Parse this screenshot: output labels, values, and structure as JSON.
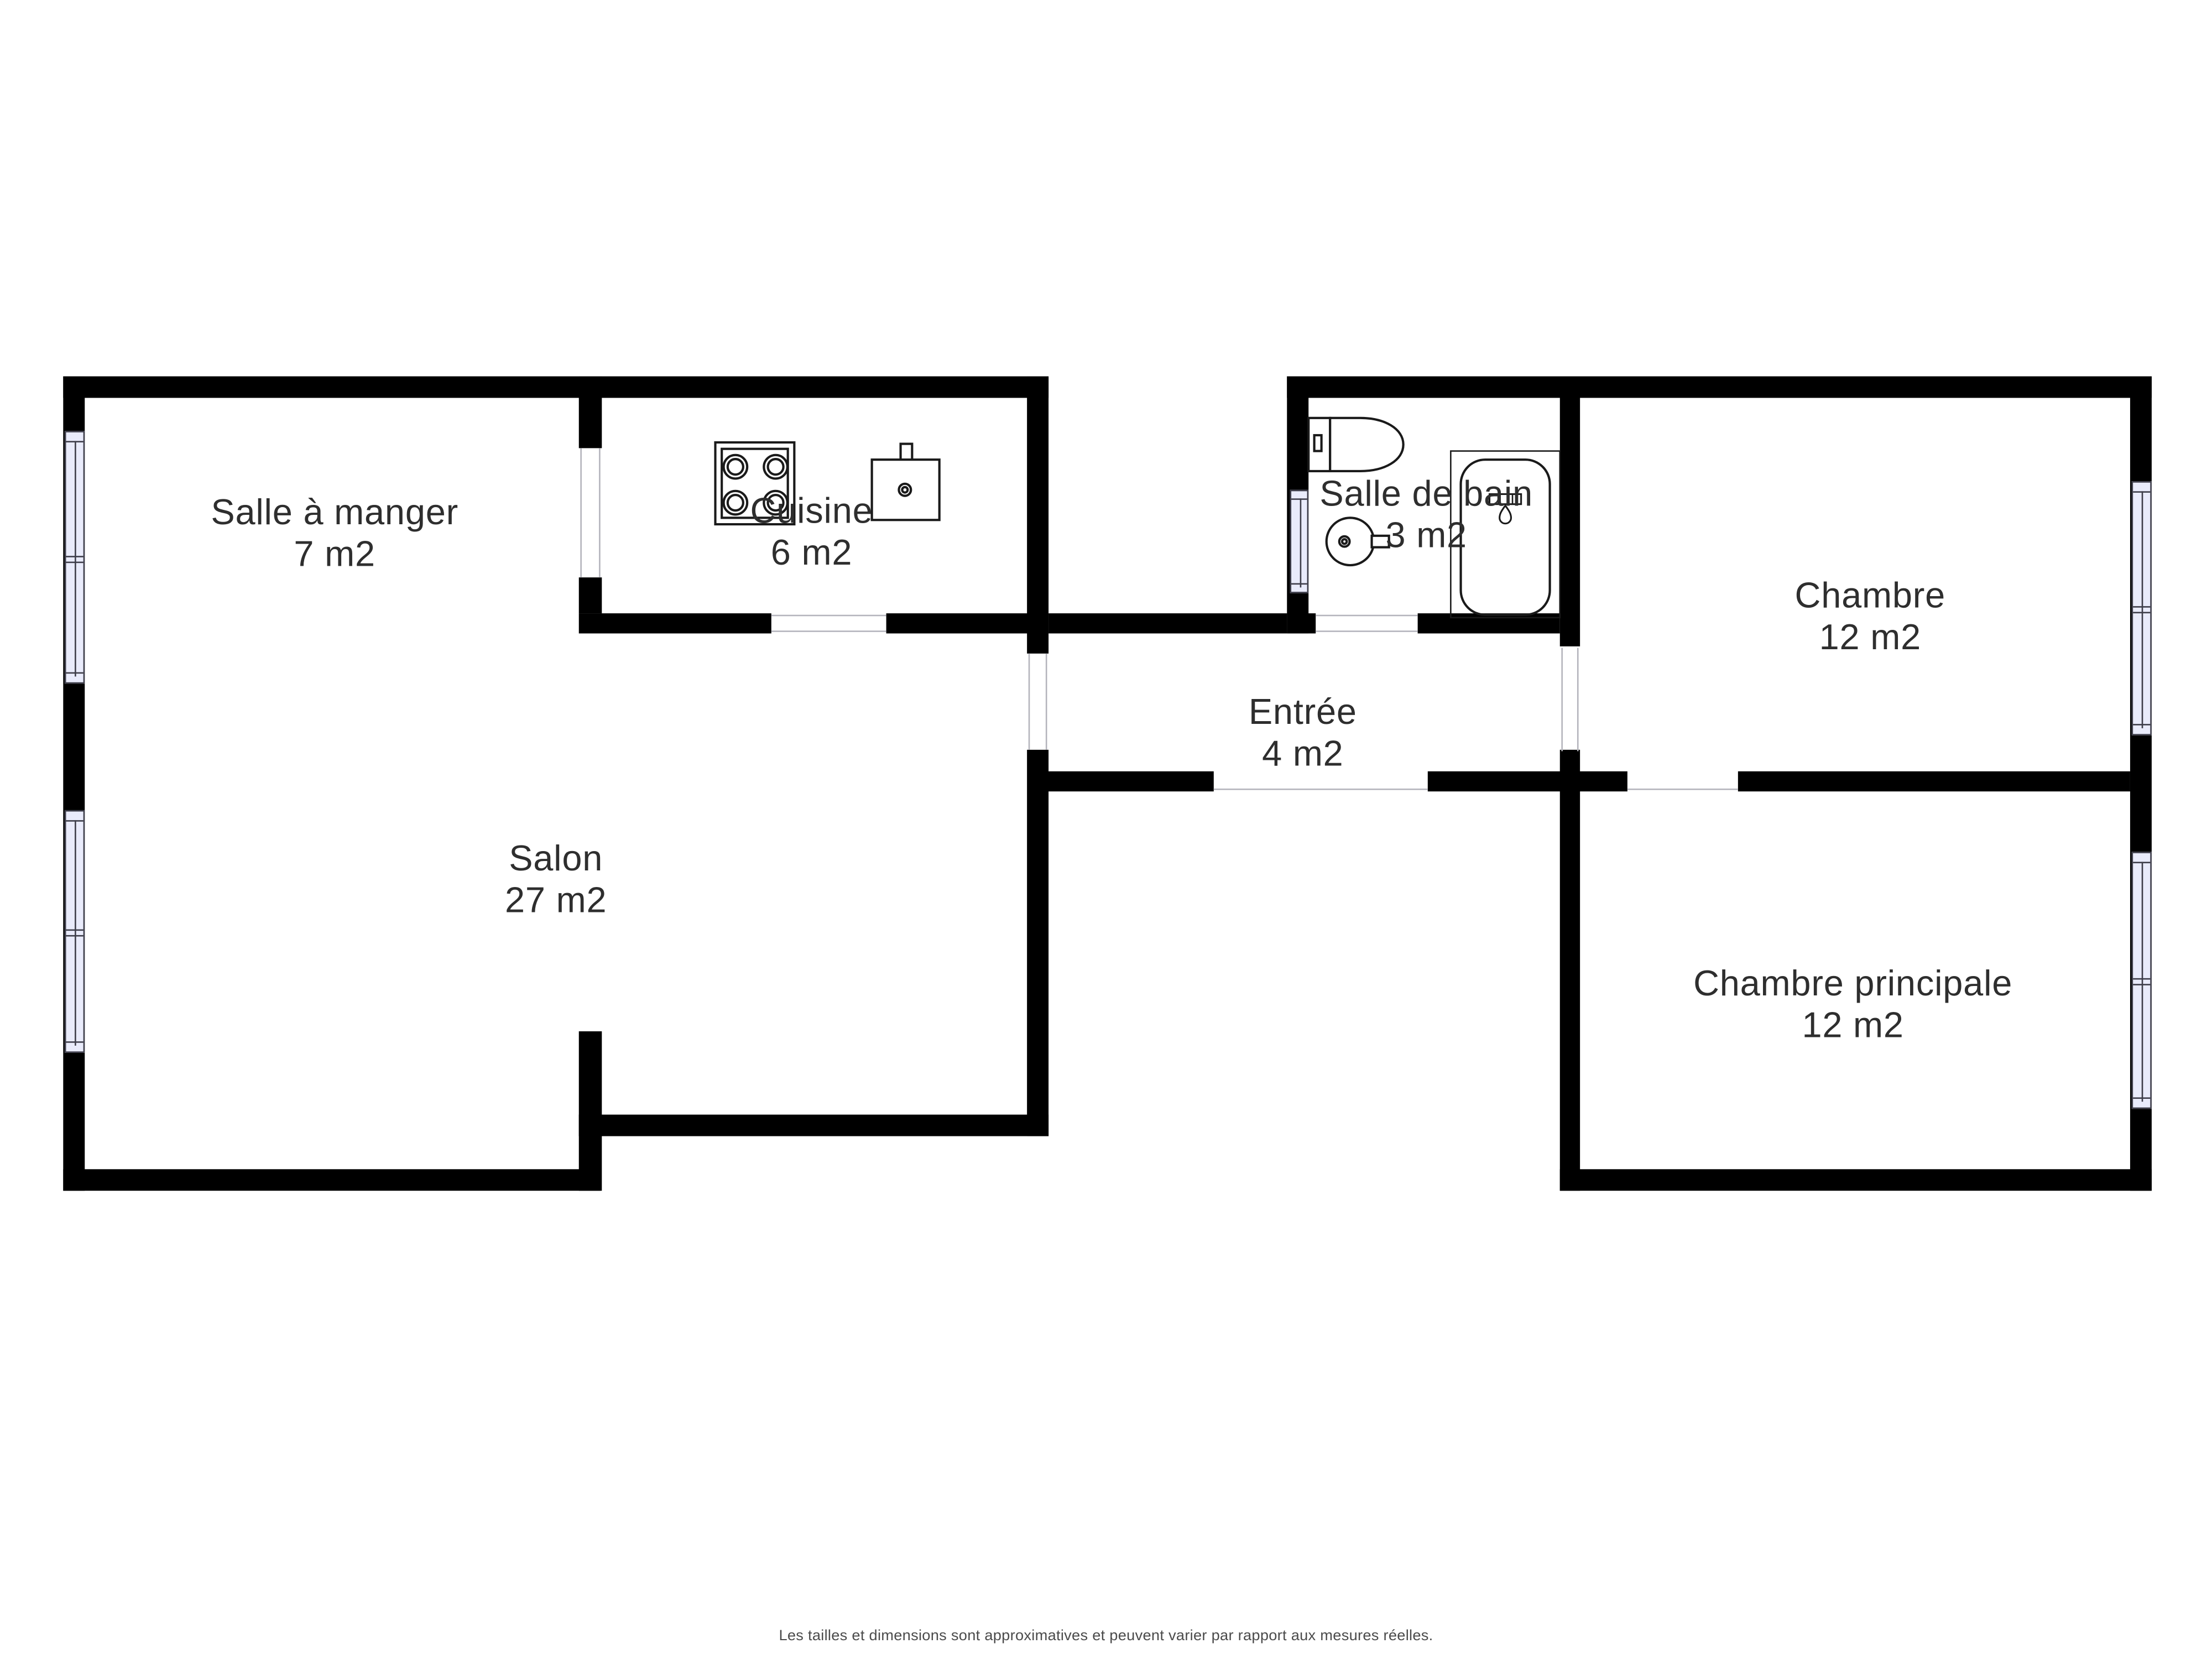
{
  "page": {
    "background": "#ffffff",
    "type": "apartment-floor-plan"
  },
  "rooms": [
    {
      "id": "salle-a-manger",
      "name": "Salle à manger",
      "area": "7 m2"
    },
    {
      "id": "cuisine",
      "name": "Cuisine",
      "area": "6 m2"
    },
    {
      "id": "salle-de-bain",
      "name": "Salle de bain",
      "area": "3 m2"
    },
    {
      "id": "chambre",
      "name": "Chambre",
      "area": "12 m2"
    },
    {
      "id": "entree",
      "name": "Entrée",
      "area": "4 m2"
    },
    {
      "id": "salon",
      "name": "Salon",
      "area": "27 m2"
    },
    {
      "id": "chambre-principale",
      "name": "Chambre principale",
      "area": "12 m2"
    }
  ],
  "fixtures": [
    {
      "icon": "stove-icon",
      "room": "cuisine"
    },
    {
      "icon": "kitchen-sink-icon",
      "room": "cuisine"
    },
    {
      "icon": "toilet-icon",
      "room": "salle-de-bain"
    },
    {
      "icon": "washbasin-icon",
      "room": "salle-de-bain"
    },
    {
      "icon": "bathtub-icon",
      "room": "salle-de-bain"
    }
  ],
  "windows": {
    "count": 5,
    "locations": [
      "left-wall-upper",
      "left-wall-lower",
      "right-wall-upper",
      "right-wall-lower",
      "bathroom-left-wall"
    ]
  },
  "colors": {
    "wall": "#000000",
    "window_fill": "#e9ebfb",
    "window_frame": "#3d3d49",
    "door_line": "#b4b4bc",
    "label_text": "#2e2e2e",
    "footer_text": "#4b4b4b",
    "fixture_stroke": "#1a1a1a"
  },
  "footer": {
    "disclaimer": "Les tailles et dimensions sont approximatives et peuvent varier par rapport aux mesures réelles."
  }
}
